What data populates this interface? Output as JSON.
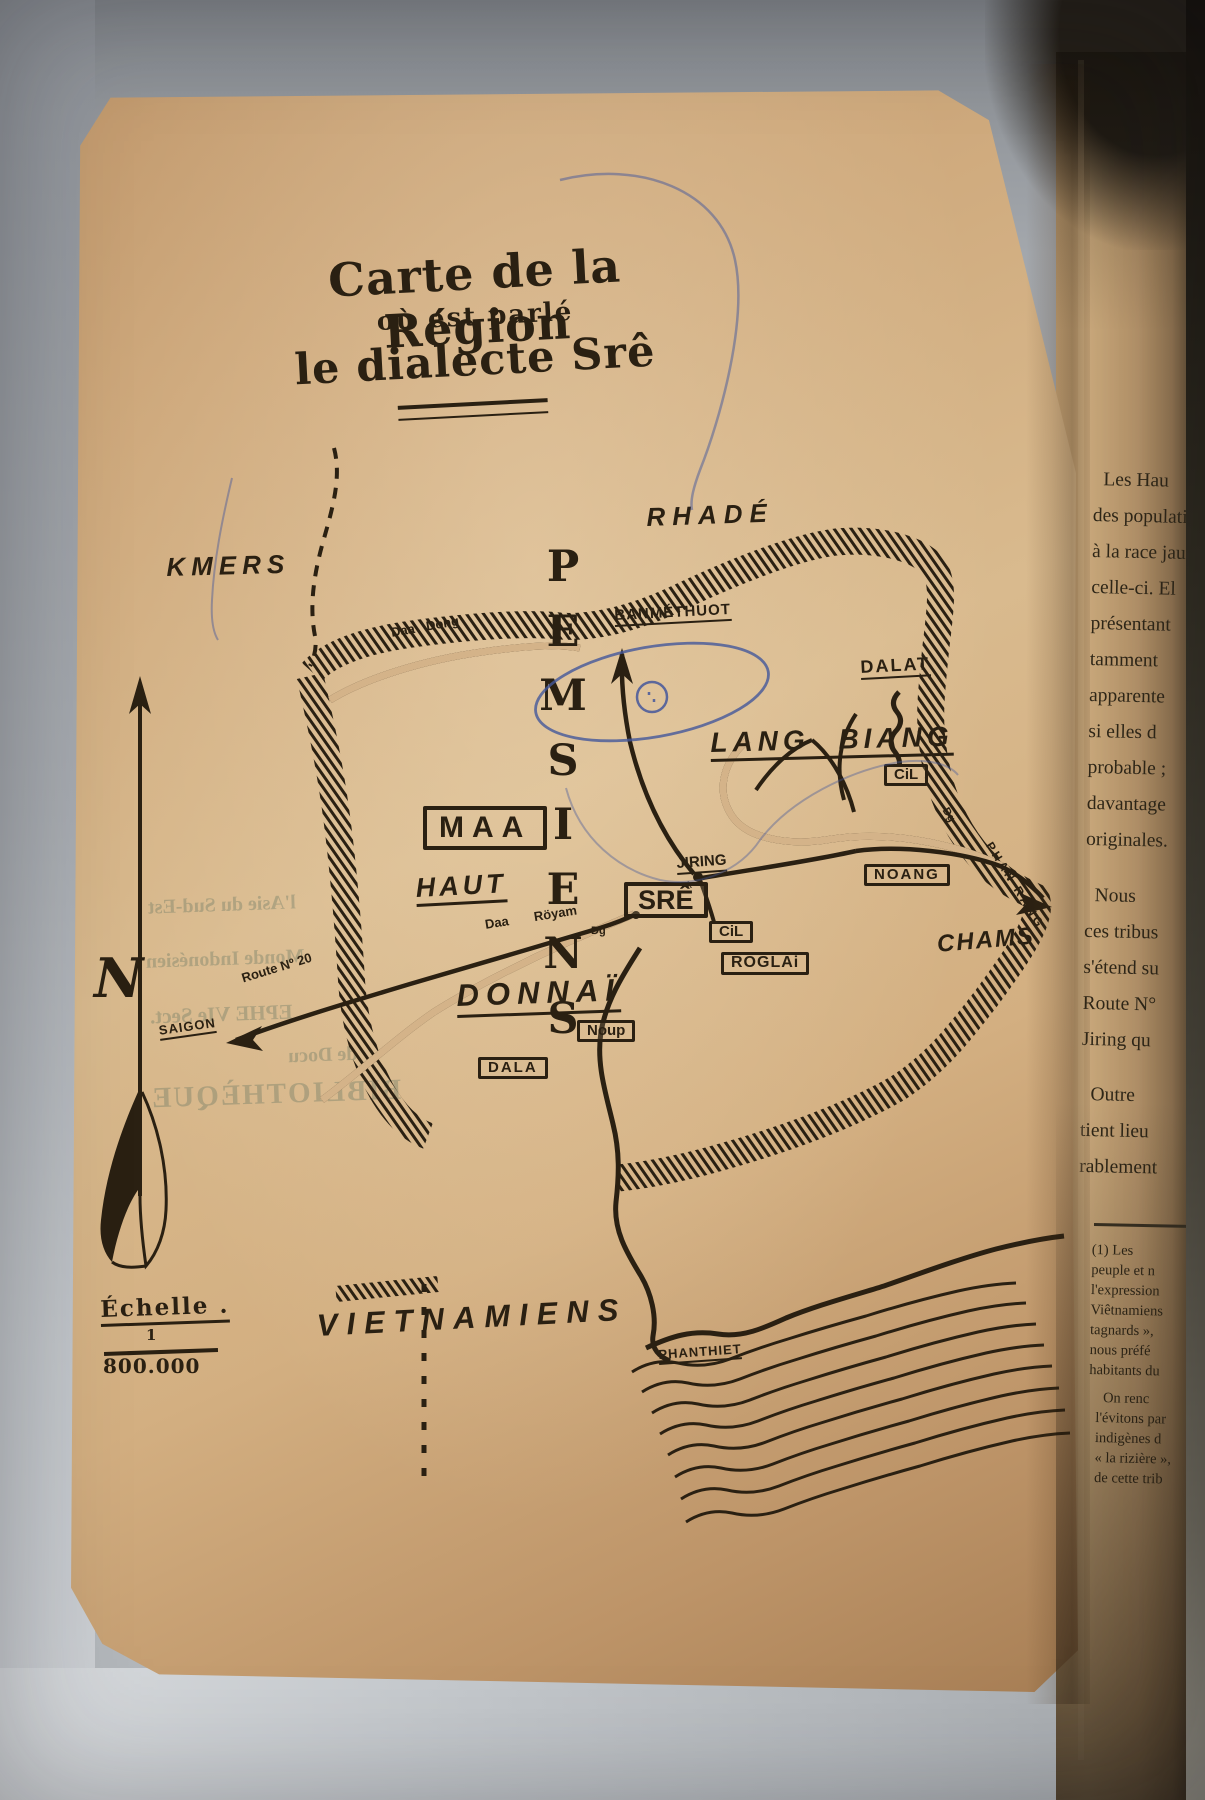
{
  "photo": {
    "ink": "#2a2012",
    "paper": "#d2ad80",
    "pen_blue": "#44579b",
    "background_gray": "#9b9fa4"
  },
  "title": {
    "line1": "Carte de la Région",
    "line2": "où est parlé",
    "line3": "le dialecte Srê"
  },
  "map": {
    "regions": {
      "rhade": "RHADÉ",
      "kmers": "KMERS",
      "lang_biang": "LANG BIANG",
      "chams": "CHAMS",
      "haut": "HAUT",
      "donnai": "DONNAÏ",
      "vietnamiens": "VIETNAMIENS"
    },
    "pemsiens_letters": [
      "P",
      "E",
      "M",
      "S",
      "I",
      "E",
      "N",
      "S"
    ],
    "boxes": {
      "maa": "MAA",
      "sre": "SRÊ",
      "cil_north": "CiL",
      "cil_center": "CiL",
      "roglai": "RÖGLAi",
      "noang": "NOANG",
      "noup": "Noup",
      "dala": "DALA"
    },
    "places": {
      "banmethuot": "BANMÉTHUOT",
      "dalat": "DALAT",
      "jiring": "JIRING",
      "jiring_k": "k",
      "saigon": "SAIGON",
      "phanthiet": "PHANTHIET",
      "phan_rang": "PHAN RANG",
      "dg_sre": "Dg",
      "dg_east": "Dg"
    },
    "rivers": {
      "daa_dong": "Daa Dong",
      "daa_royam": "Daa Röyam"
    },
    "route_20": "Route Nº 20",
    "compass_n": "N",
    "scale": {
      "label": "Échelle .",
      "numerator": "1",
      "denominator": "800.000"
    }
  },
  "facing_page": {
    "main_lines": [
      "  Les Hau",
      "des populati",
      "à la race jau",
      "celle-ci. El",
      "présentant",
      "tamment",
      "apparente",
      "si elles d",
      "probable ;",
      "davantage",
      "originales.",
      "",
      "  Nous",
      "ces tribus",
      "s'étend su",
      "Route N°",
      "Jiring qu",
      "",
      "  Outre",
      "tient lieu",
      "rablement"
    ],
    "footnote1_lines": [
      "(1) Les",
      "peuple et n",
      "l'expression",
      "Viêtnamiens",
      "tagnards »,",
      "nous préfé",
      "habitants du"
    ],
    "footnote2_lines": [
      "  On renc",
      "l'évitons par",
      "indigènes d",
      "« la rizière »,",
      "de cette trib"
    ]
  },
  "ghost_stamp": {
    "lines": [
      "l'Asie du Sud-Est",
      "Monde Indonésien",
      "EPHE VIe Sect.",
      "de Docu",
      "BIBLIOTHÈQUE"
    ]
  }
}
